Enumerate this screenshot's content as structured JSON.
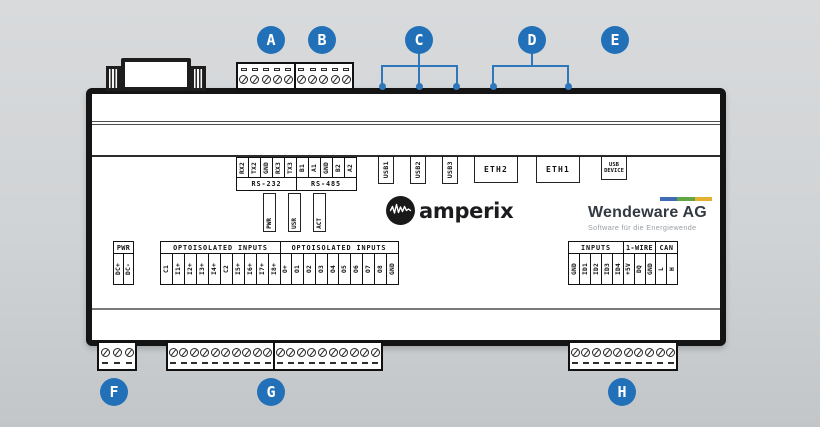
{
  "colors": {
    "marker_blue": "#2271b8",
    "device_outline": "#141414",
    "brand_bar_blue": "#3f6db4",
    "brand_bar_green": "#61a643",
    "brand_bar_yellow": "#e5af30"
  },
  "markers": {
    "a": "A",
    "b": "B",
    "c": "C",
    "d": "D",
    "e": "E",
    "f": "F",
    "g": "G",
    "h": "H"
  },
  "terminal_blocks": {
    "a_screws": 5,
    "b_screws": 5,
    "f_screws": 3,
    "g1_screws": 10,
    "g2_screws": 10,
    "h_screws": 10
  },
  "serial": {
    "rs232": {
      "label": "RS-232",
      "pins": [
        "RX2",
        "TX2",
        "GND",
        "RX3",
        "TX3"
      ]
    },
    "rs485": {
      "label": "RS-485",
      "pins": [
        "B1",
        "A1",
        "GND",
        "B2",
        "A2"
      ]
    }
  },
  "ports": {
    "usb1": "USB1",
    "usb2": "USB2",
    "usb3": "USB3",
    "eth2": "ETH2",
    "eth1": "ETH1",
    "usb_device": "USB DEVICE"
  },
  "leds": {
    "pwr": "PWR",
    "usr": "USR",
    "act": "ACT"
  },
  "branding": {
    "amperix": "amperix",
    "wendeware": "Wendeware AG",
    "wendeware_subtitle": "Software für die Energiewende"
  },
  "power": {
    "label": "PWR",
    "pins": [
      "DC+",
      "DC-"
    ]
  },
  "opto_inputs_1": {
    "label": "OPTOISOLATED INPUTS",
    "pins": [
      "C1",
      "I1+",
      "I2+",
      "I3+",
      "I4+",
      "C2",
      "I5+",
      "I6+",
      "I7+",
      "I8+"
    ]
  },
  "opto_inputs_2": {
    "label": "OPTOISOLATED INPUTS",
    "pins": [
      "O+",
      "O1",
      "O2",
      "O3",
      "O4",
      "O5",
      "O6",
      "O7",
      "O8",
      "GND"
    ]
  },
  "right_io": {
    "inputs": {
      "label": "INPUTS",
      "pins": [
        "GND",
        "ID1",
        "ID2",
        "ID3",
        "ID4"
      ]
    },
    "one_wire": {
      "label": "1-WIRE",
      "pins": [
        "+5V",
        "DQ",
        "GND"
      ]
    },
    "can": {
      "label": "CAN",
      "pins": [
        "L",
        "H"
      ]
    }
  }
}
